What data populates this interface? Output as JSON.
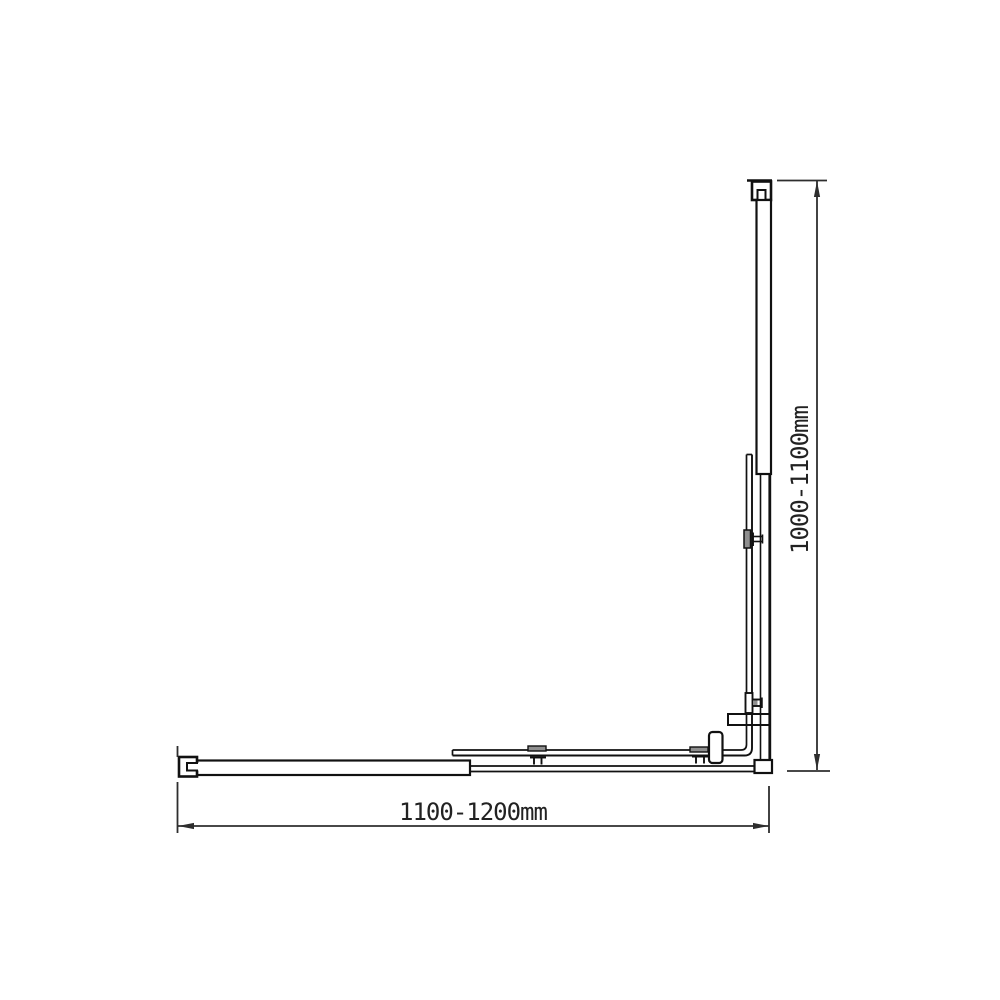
{
  "drawing": {
    "kind": "technical-dimension-diagram",
    "view": "plan-view-corner-screen"
  },
  "dimensions": {
    "height_label": "1000-1100mm",
    "width_label": "1100-1200mm"
  },
  "colors": {
    "background": "#ffffff",
    "part_line": "#111111",
    "dimension_line": "#2e2e2e",
    "bracket_pad_fill": "#8f8f8f",
    "text": "#222222"
  }
}
